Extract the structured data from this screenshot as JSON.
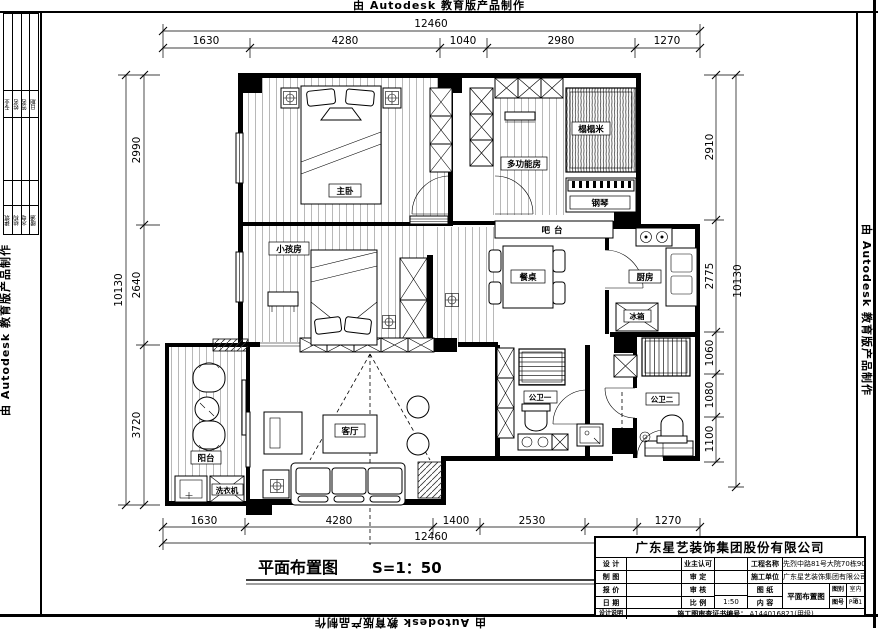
{
  "autodesk_banner": "由 Autodesk 教育版产品制作",
  "drawing": {
    "title": "平面布置图",
    "scale_text": "S=1：50",
    "rooms": {
      "master_bedroom": "主卧",
      "kids_room": "小孩房",
      "multi_room": "多功能房",
      "tatami": "榻榻米",
      "piano": "钢琴",
      "bar": "吧台",
      "dining_table": "餐桌",
      "kitchen": "厨房",
      "fridge": "冰箱",
      "living_room": "客厅",
      "balcony": "阳台",
      "washer": "洗衣机",
      "bath_1": "公卫一",
      "bath_2": "公卫二"
    },
    "dims": {
      "top": {
        "overall": "12460",
        "seg": [
          "1630",
          "4280",
          "1040",
          "2980",
          "1270"
        ]
      },
      "bottom": {
        "overall": "12460",
        "seg": [
          "1630",
          "4280",
          "1400",
          "2530",
          "1270"
        ]
      },
      "left": {
        "overall": "10130",
        "seg": [
          "2990",
          "2640",
          "3720"
        ]
      },
      "right": {
        "overall": "10130",
        "seg": [
          "2910",
          "2775",
          "1060",
          "1080",
          "1100"
        ]
      }
    }
  },
  "title_block": {
    "company": "广东星艺装饰集团股份有限公司",
    "design_label": "设 计",
    "owner_approve_label": "业主认可",
    "project_label": "工程名称",
    "project_value": "先烈中路81号大院70栋904号",
    "draft_label": "制 图",
    "approve_label": "审 定",
    "builder_label": "施工单位",
    "builder_value": "广东星艺装饰集团有限公司",
    "quote_label": "报 价",
    "review_label": "审 核",
    "sheet_label": "图 纸",
    "content_label": "内 容",
    "sheet_value": "平面布置图",
    "date_label": "日 期",
    "scale_label": "比 例",
    "scale_value": "1:50",
    "category_label": "图别",
    "category_value": "室内施",
    "number_label": "图号",
    "number_value": "P-01",
    "notes_label": "设计说明",
    "cert_label": "施工图审查证书编号：",
    "cert_value": "A144016821(甲级)"
  },
  "signature_strip": {
    "headers": [
      "专业",
      "姓名",
      "签名",
      "日期"
    ],
    "trades": [
      "建筑",
      "结构",
      "水电",
      "暖通"
    ]
  }
}
